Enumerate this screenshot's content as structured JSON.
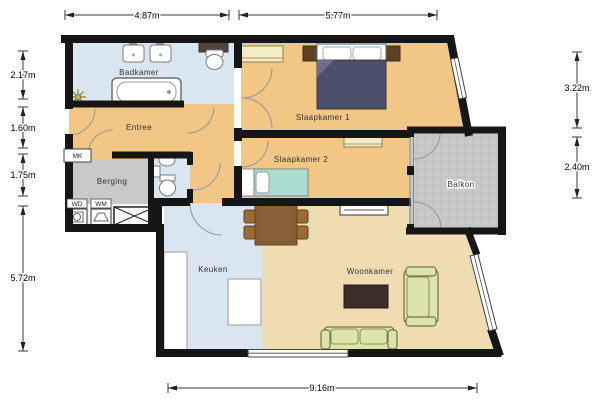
{
  "plan": {
    "type": "apartment-floor-plan",
    "units": "meters"
  },
  "rooms": {
    "badkamer": {
      "label": "Badkamer"
    },
    "entree": {
      "label": "Entree"
    },
    "berging": {
      "label": "Berging"
    },
    "slaapkamer1": {
      "label": "Slaapkamer 1"
    },
    "slaapkamer2": {
      "label": "Slaapkamer 2"
    },
    "balkon": {
      "label": "Balkon"
    },
    "keuken": {
      "label": "Keuken"
    },
    "woonkamer": {
      "label": "Woonkamer"
    }
  },
  "small_labels": {
    "mk": "MK",
    "wd": "WD",
    "wm": "WM"
  },
  "dimensions": {
    "top": [
      {
        "label": "4.87m"
      },
      {
        "label": "5.77m"
      }
    ],
    "left": [
      {
        "label": "2.17m"
      },
      {
        "label": "1.60m"
      },
      {
        "label": "1.75m"
      },
      {
        "label": "5.72m"
      }
    ],
    "right": [
      {
        "label": "3.22m"
      },
      {
        "label": "2.40m"
      }
    ],
    "bottom": [
      {
        "label": "9.16m"
      }
    ]
  },
  "colors": {
    "wall": "#161616",
    "floor_orange": "#f2c685",
    "floor_tan": "#f0dcb2",
    "floor_blue": "#d9e6f2",
    "floor_gray": "#c9c9c9",
    "cabinet_cream": "#f5ecc5",
    "bed_double": "#4b4f6b",
    "bed_single": "#abdcd0",
    "wood_brown": "#8a6138",
    "sofa_green": "#dde3ac",
    "tv_dark": "#3a2d2a"
  },
  "symbols": [
    "bathtub",
    "sink",
    "toilet",
    "ceiling-light",
    "washing-machine",
    "dryer",
    "shaft-cross",
    "double-bed",
    "nightstand",
    "pillow",
    "wardrobe",
    "single-bed",
    "dresser",
    "dining-table",
    "chair",
    "kitchen-counter",
    "kitchen-island",
    "radiator",
    "tv",
    "sofa",
    "door-arc",
    "window",
    "dimension-arrow"
  ]
}
